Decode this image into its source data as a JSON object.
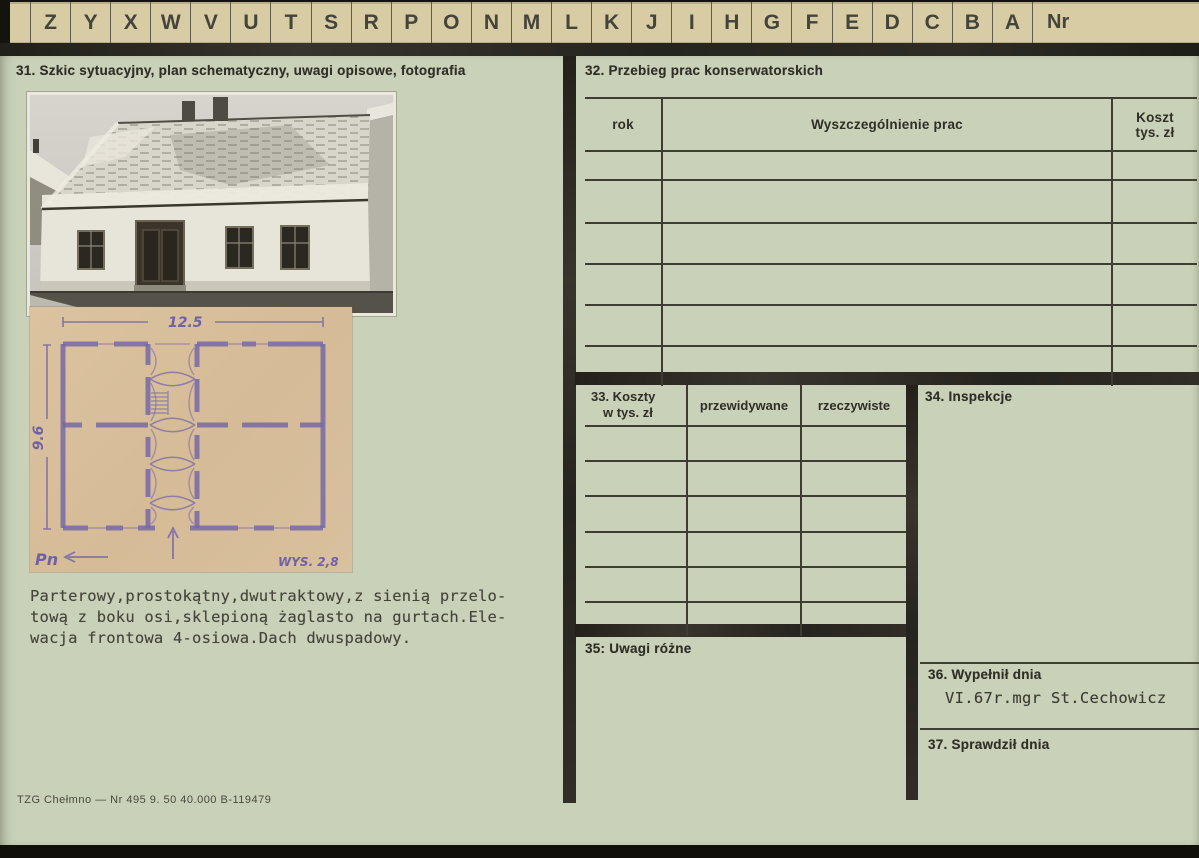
{
  "tabs": {
    "letters": [
      "Z",
      "Y",
      "X",
      "W",
      "V",
      "U",
      "T",
      "S",
      "R",
      "P",
      "O",
      "N",
      "M",
      "L",
      "K",
      "J",
      "I",
      "H",
      "G",
      "F",
      "E",
      "D",
      "C",
      "B",
      "A"
    ],
    "nr_label": "Nr"
  },
  "left": {
    "section31_title": "31. Szkic sytuacyjny, plan schematyczny, uwagi opisowe, fotografia",
    "plan": {
      "width_dim": "12.5",
      "depth_dim": "9.6",
      "height_note": "WYS. 2,8",
      "north_label": "Pn"
    },
    "description": "Parterowy,prostokątny,dwutraktowy,z sienią przelo-\ntową z boku osi,sklepioną żaglasto na gurtach.Ele-\nwacja frontowa 4-osiowa.Dach dwuspadowy.",
    "imprint": "TZG Chełmno — Nr 495 9. 50 40.000  B-119479"
  },
  "right": {
    "section32": {
      "title": "32. Przebieg prac konserwatorskich",
      "col_rok": "rok",
      "col_prace": "Wyszczególnienie prac",
      "col_koszt_line1": "Koszt",
      "col_koszt_line2": "tys. zł",
      "empty_rows": 6
    },
    "section33": {
      "title_line1": "33. Koszty",
      "title_line2": "w tys. zł",
      "col_przewidywane": "przewidywane",
      "col_rzeczywiste": "rzeczywiste",
      "empty_rows": 6
    },
    "section34": {
      "title": "34. Inspekcje"
    },
    "section35": {
      "title": "35: Uwagi różne"
    },
    "section36": {
      "title": "36. Wypełnił dnia",
      "value": "VI.67r.mgr St.Cechowicz"
    },
    "section37": {
      "title": "37. Sprawdził dnia"
    }
  },
  "colors": {
    "card_green": "#c9d1b8",
    "tab_tan": "#d8cca4",
    "bar_dark": "#26241d",
    "plan_paper": "#d8bf9c",
    "plan_ink": "#7568a8"
  }
}
